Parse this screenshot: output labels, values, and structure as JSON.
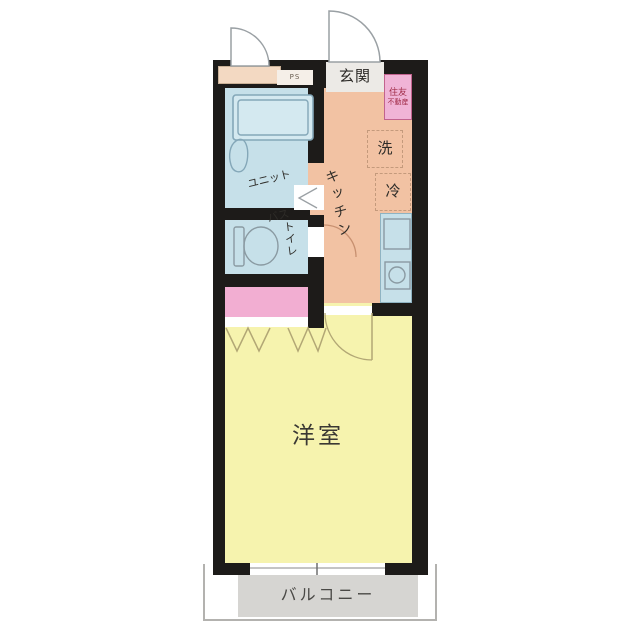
{
  "floorplan": {
    "title": "one-room apartment floor plan",
    "rooms": {
      "entrance": {
        "label": "玄関"
      },
      "unit_bath": {
        "label_line1": "ユニット",
        "label_line2": "バス"
      },
      "toilet": {
        "label": "トイレ"
      },
      "kitchen": {
        "label": "キッチン"
      },
      "western_room": {
        "label": "洋室"
      },
      "balcony": {
        "label": "バルコニー"
      }
    },
    "appliances": {
      "washer": {
        "label": "洗"
      },
      "fridge": {
        "label": "冷"
      }
    },
    "pipe_space": {
      "label": "PS"
    },
    "stamp": {
      "line1": "住友",
      "line2": "不動産"
    }
  },
  "colors": {
    "wall": "#1d1b19",
    "bath": "#c6e0e9",
    "tubfill": "#d4e9f0",
    "kitchen": "#f2c2a3",
    "closet": "#f2aed2",
    "room": "#f6f3ae",
    "balcony": "#d6d5d2",
    "genkan": "#eceae6",
    "sill": "#f3d9c2",
    "counter": "#c6e0e9",
    "stamp-bg": "#f0b4d6",
    "stamp-text": "#a02c48",
    "line": "#9aa0a4",
    "door": "#b2a775",
    "fixture": "#84a7b8",
    "dash": "#c49a7c"
  }
}
